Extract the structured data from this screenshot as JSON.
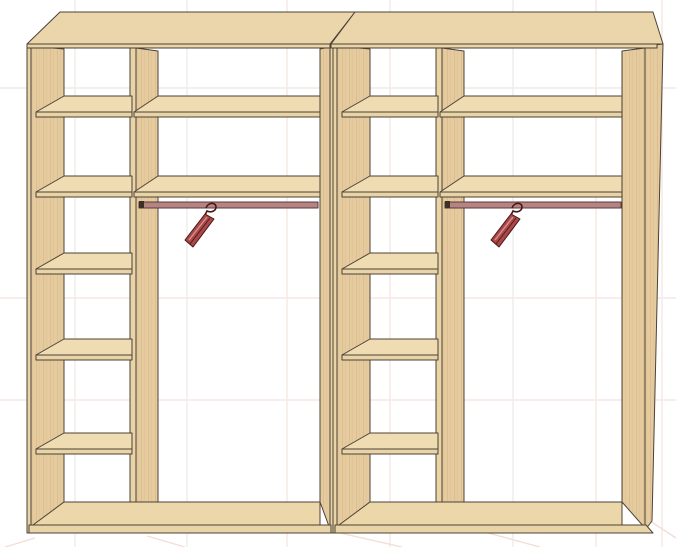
{
  "app": {
    "title": "Wardrobe interior 3D render"
  },
  "canvas": {
    "width": 676,
    "height": 547,
    "background": "#ffffff"
  },
  "grid": {
    "vertical_x": [
      75,
      187,
      287,
      390,
      513,
      596,
      662
    ],
    "vertical_colors": [
      "#ececec",
      "#ececec",
      "#f7e7e2",
      "#f7e7e2",
      "#ececec",
      "#f7e7e2",
      "#f7e7e2"
    ],
    "horizontal_y": [
      88,
      298,
      400
    ],
    "horizontal_colors": [
      "#ececec",
      "#f7e7e2",
      "#f7e7e2"
    ],
    "diagonals": [
      [
        35,
        538,
        5,
        547
      ],
      [
        147,
        536,
        185,
        547
      ],
      [
        340,
        533,
        402,
        547
      ],
      [
        488,
        533,
        540,
        547
      ],
      [
        650,
        521,
        676,
        538
      ]
    ],
    "diagonal_color": "#f3ded7"
  },
  "colors": {
    "outline": "#4c4236",
    "top_face": "#ebd6ac",
    "shelf_top": "#efdcb2",
    "side_face": "#e5cb9e",
    "edge_strip": "#e9d4a8",
    "floor_top": "#ecd7ab",
    "rail": "#b48484",
    "rail_outline": "#5c3a3a",
    "bracket": "#3c2f28",
    "hanger_fill": "#a84848",
    "hanger_light": "#d89090",
    "hanger_outline": "#4a1515"
  },
  "units": [
    {
      "name": "left",
      "dx": 0,
      "right_edge": "seam"
    },
    {
      "name": "right",
      "dx": 306,
      "right_edge": "outer"
    }
  ],
  "geometry": {
    "narrow_shelf_front_ys": [
      112,
      192,
      269,
      355,
      449
    ],
    "wide_shelf_front_ys": [
      112,
      192
    ],
    "shelf_rise": 16,
    "shelf_thickness": 5,
    "rail": {
      "x1": 139,
      "y": 202,
      "height": 6
    },
    "hanger_pos": {
      "x": 183,
      "y": 203
    }
  },
  "contents": {
    "units_count": 2,
    "shelves_per_side_column": 5,
    "top_shelves_per_unit": 2,
    "rails_count": 2,
    "hangers_count": 2
  }
}
